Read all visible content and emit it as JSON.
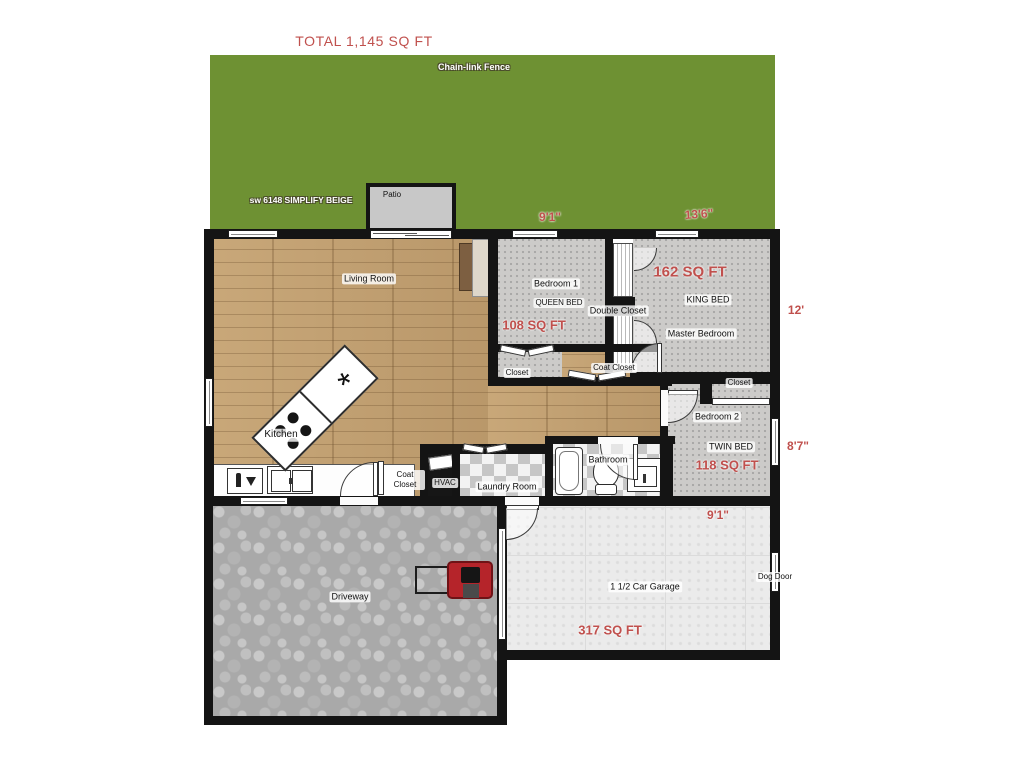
{
  "title": "TOTAL 1,145 SQ FT",
  "yard": {
    "fence_label": "Chain-link Fence",
    "paint_label": "sw 6148 SIMPLIFY BEIGE"
  },
  "patio": {
    "label": "Patio"
  },
  "living_room": {
    "label": "Living Room"
  },
  "kitchen": {
    "label": "Kitchen"
  },
  "bedroom1": {
    "label": "Bedroom 1",
    "bed": "QUEEN BED",
    "area": "108 SQ FT",
    "dim_width": "9'1\"",
    "closet": "Closet"
  },
  "master": {
    "label": "Master Bedroom",
    "bed": "KING BED",
    "area": "162 SQ FT",
    "dim_width": "13'6\"",
    "dim_depth": "12'"
  },
  "double_closet": {
    "label": "Double Closet"
  },
  "coat_closet_hall": {
    "label": "Coat Closet"
  },
  "bedroom2": {
    "label": "Bedroom 2",
    "bed": "TWIN BED",
    "area": "118 SQ FT",
    "dim_depth": "8'7\"",
    "closet": "Closet"
  },
  "bathroom": {
    "label": "Bathroom"
  },
  "laundry": {
    "label": "Laundry Room"
  },
  "hvac": {
    "label": "HVAC"
  },
  "coat_closet_entry": {
    "label": "Coat Closet"
  },
  "driveway": {
    "label": "Driveway"
  },
  "garage": {
    "label": "1 1/2 Car Garage",
    "area": "317 SQ FT",
    "dim_width": "9'1\""
  },
  "dog_door": {
    "label": "Dog Door"
  },
  "colors": {
    "accent_red": "#C0504D",
    "yard_green": "#6E9133",
    "wall": "#141414",
    "wood": "#C2A071",
    "carpet": "#CCCBC9",
    "patio_gray": "#C8C8C8"
  }
}
